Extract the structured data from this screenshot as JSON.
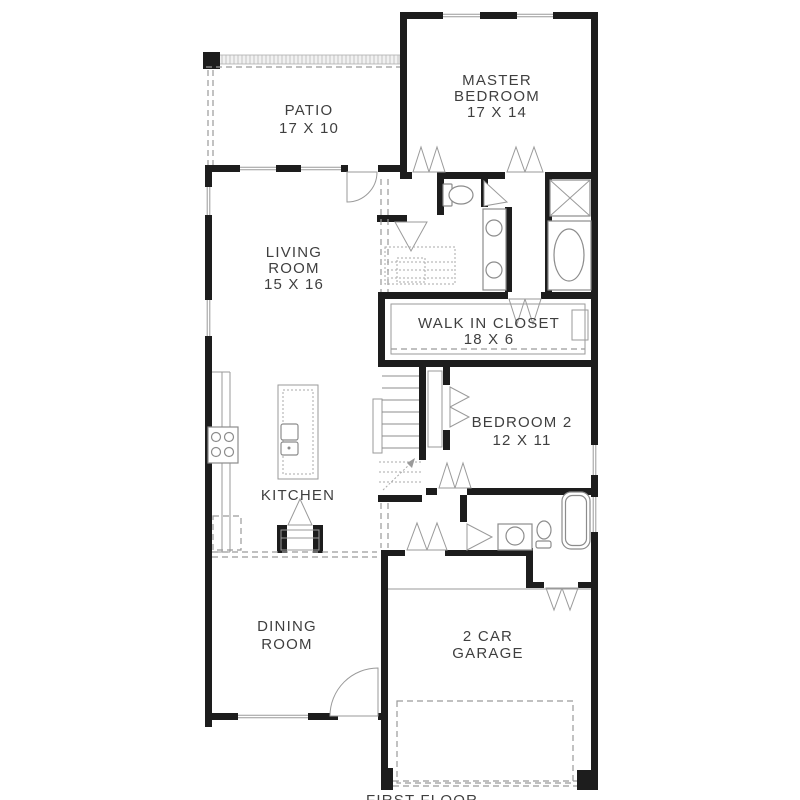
{
  "plan": {
    "floor_label": "FIRST FLOOR",
    "rooms": {
      "patio": {
        "line1": "PATIO",
        "line2": "17 X 10"
      },
      "master_bedroom": {
        "line1": "MASTER",
        "line2": "BEDROOM",
        "line3": "17 X 14"
      },
      "living_room": {
        "line1": "LIVING",
        "line2": "ROOM",
        "line3": "15 X 16"
      },
      "walk_in_closet": {
        "line1": "WALK IN CLOSET",
        "line2": "18 X 6"
      },
      "bedroom_2": {
        "line1": "BEDROOM 2",
        "line2": "12 X 11"
      },
      "kitchen": {
        "line1": "KITCHEN"
      },
      "dining_room": {
        "line1": "DINING",
        "line2": "ROOM"
      },
      "garage": {
        "line1": "2 CAR",
        "line2": "GARAGE"
      }
    },
    "colors": {
      "wall": "#1d1d1d",
      "text": "#3f3f3f",
      "fixture_line": "#8c8c8c",
      "background": "#ffffff"
    }
  }
}
